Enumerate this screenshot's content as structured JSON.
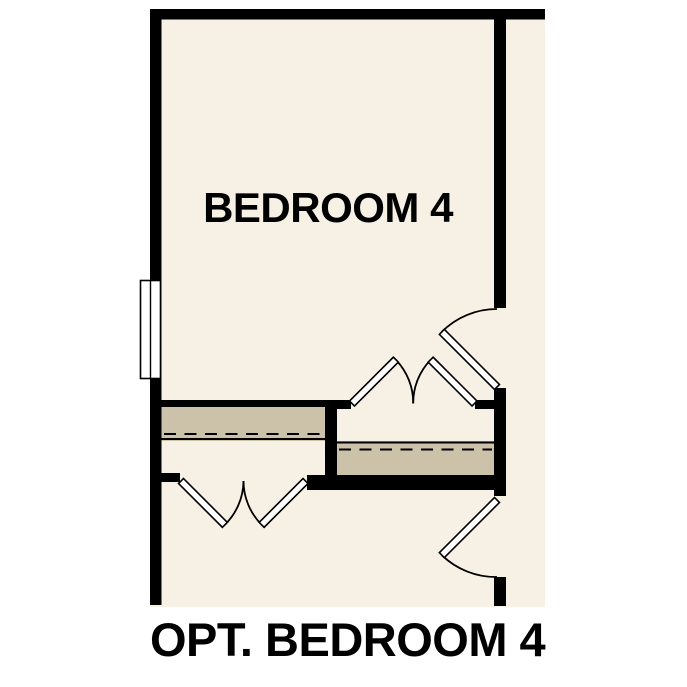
{
  "plan": {
    "room_label": "BEDROOM 4",
    "caption": "OPT. BEDROOM 4"
  },
  "colors": {
    "background": "#ffffff",
    "floor": "#f7f0e4",
    "wall": "#000000",
    "shelf": "#ccc2a9",
    "door": "#ffffff",
    "line": "#000000",
    "label": "#000000"
  }
}
